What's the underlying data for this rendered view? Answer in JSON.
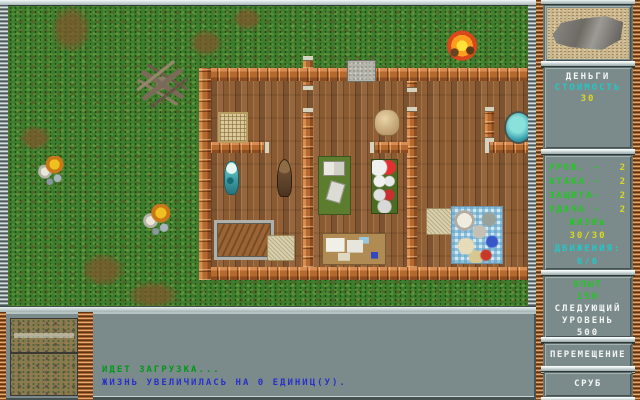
{
  "colors": {
    "panel_gray": "#7b8b8b",
    "label_green": "#20c820",
    "value_yellow": "#d8d820",
    "accent_cyan": "#20c8c8",
    "msg_green": "#009818",
    "msg_blue": "#2830c8",
    "wall_orange": "#bc6f38",
    "grass_green": "#3f7d2e"
  },
  "sidebar": {
    "money": {
      "title": "ДЕНЬГИ",
      "cost_label": "СТОИМОСТЬ",
      "cost_value": "30"
    },
    "stats": {
      "rows": [
        {
          "label": "УРОВ. -",
          "value": "2"
        },
        {
          "label": "АТАКА -",
          "value": "2"
        },
        {
          "label": "ЗАЩИТА-",
          "value": "2"
        },
        {
          "label": "УДАЧА -",
          "value": "2"
        }
      ],
      "life_label": "ЖИЗНЬ",
      "life_value": "30/30",
      "moves_label": "ДВИЖЕНИЯ:",
      "moves_value": "6/6"
    },
    "experience": {
      "label": "ОПЫТ",
      "value": "150",
      "next_line_1": "СЛЕДУЮЩИЙ",
      "next_line_2": "УРОВЕНЬ",
      "next_value": "500"
    },
    "buttons": [
      {
        "label": "ПЕРЕМЕЩЕНИЕ"
      },
      {
        "label": "СРУБ"
      }
    ]
  },
  "messages": {
    "line1": "ИДЕТ ЗАГРУЗКА...",
    "line2": "ЖИЗНЬ УВЕЛИЧИЛАСЬ НА 0 ЕДИНИЦ(У)."
  },
  "map": {
    "objects": [
      {
        "name": "dirt-patch",
        "cls": "dirt",
        "x": 44,
        "y": 0,
        "w": 38,
        "h": 46,
        "it": false
      },
      {
        "name": "dirt-patch",
        "cls": "dirt",
        "x": 182,
        "y": 24,
        "w": 32,
        "h": 26,
        "it": false
      },
      {
        "name": "dirt-patch",
        "cls": "dirt",
        "x": 225,
        "y": 2,
        "w": 28,
        "h": 22,
        "it": false
      },
      {
        "name": "dirt-patch",
        "cls": "dirt",
        "x": 12,
        "y": 120,
        "w": 30,
        "h": 24,
        "it": false
      },
      {
        "name": "dirt-patch",
        "cls": "dirt",
        "x": 74,
        "y": 248,
        "w": 42,
        "h": 32,
        "it": false
      },
      {
        "name": "dirt-patch",
        "cls": "dirt",
        "x": 120,
        "y": 276,
        "w": 50,
        "h": 26,
        "it": false
      },
      {
        "name": "dead-tree",
        "cls": "dead-tree",
        "x": 125,
        "y": 52,
        "w": 58,
        "h": 50,
        "it": true
      },
      {
        "name": "flower-cluster",
        "cls": "flowers",
        "x": 28,
        "y": 150,
        "w": 30,
        "h": 30,
        "it": true
      },
      {
        "name": "flower-cluster",
        "cls": "flowers",
        "x": 133,
        "y": 198,
        "w": 32,
        "h": 32,
        "it": true
      },
      {
        "name": "campfire",
        "cls": "campfire",
        "x": 437,
        "y": 22,
        "w": 34,
        "h": 34,
        "it": true
      },
      {
        "name": "house-floor",
        "cls": "floor",
        "x": 191,
        "y": 62,
        "w": 337,
        "h": 212,
        "it": false
      },
      {
        "name": "house-wall-top",
        "cls": "wall-h",
        "x": 191,
        "y": 62,
        "w": 337,
        "h": 13,
        "it": false
      },
      {
        "name": "house-wall-bottom",
        "cls": "wall-h",
        "x": 191,
        "y": 261,
        "w": 337,
        "h": 13,
        "it": false
      },
      {
        "name": "house-wall-left",
        "cls": "wall-v",
        "x": 191,
        "y": 62,
        "w": 12,
        "h": 212,
        "it": false
      },
      {
        "name": "chimney-stub",
        "cls": "wall-v cap-top",
        "x": 295,
        "y": 50,
        "w": 10,
        "h": 12,
        "it": false
      },
      {
        "name": "inner-wall",
        "cls": "wall-v cap-bottom",
        "x": 295,
        "y": 75,
        "w": 10,
        "h": 9,
        "it": false
      },
      {
        "name": "inner-wall",
        "cls": "wall-v cap-top",
        "x": 295,
        "y": 102,
        "w": 10,
        "h": 159,
        "it": false
      },
      {
        "name": "inner-wall",
        "cls": "wall-v cap-bottom",
        "x": 399,
        "y": 75,
        "w": 10,
        "h": 11,
        "it": false
      },
      {
        "name": "inner-wall",
        "cls": "wall-v cap-top",
        "x": 399,
        "y": 101,
        "w": 10,
        "h": 160,
        "it": false
      },
      {
        "name": "inner-wall",
        "cls": "wall-v cap-top cap-bottom",
        "x": 477,
        "y": 101,
        "w": 9,
        "h": 35,
        "it": false
      },
      {
        "name": "inner-wall",
        "cls": "wall-h cap-right",
        "x": 203,
        "y": 136,
        "w": 58,
        "h": 11,
        "it": false
      },
      {
        "name": "inner-wall",
        "cls": "wall-h cap-left",
        "x": 362,
        "y": 136,
        "w": 38,
        "h": 11,
        "it": false
      },
      {
        "name": "inner-wall",
        "cls": "wall-h cap-left",
        "x": 477,
        "y": 136,
        "w": 43,
        "h": 11,
        "it": false
      },
      {
        "name": "stone-doormat",
        "cls": "slab",
        "x": 339,
        "y": 54,
        "w": 27,
        "h": 20,
        "it": true
      },
      {
        "name": "wicker-crate",
        "cls": "basket",
        "x": 210,
        "y": 106,
        "w": 26,
        "h": 27,
        "it": true
      },
      {
        "name": "hanging-fish",
        "cls": "fish-a",
        "x": 216,
        "y": 155,
        "w": 15,
        "h": 34,
        "it": true
      },
      {
        "name": "hanging-fish",
        "cls": "fish-b",
        "x": 269,
        "y": 153,
        "w": 15,
        "h": 38,
        "it": true
      },
      {
        "name": "wooden-trough",
        "cls": "trough",
        "x": 206,
        "y": 214,
        "w": 54,
        "h": 34,
        "it": true
      },
      {
        "name": "wicker-mat",
        "cls": "mat",
        "x": 259,
        "y": 229,
        "w": 26,
        "h": 24,
        "it": true
      },
      {
        "name": "writing-desk",
        "cls": "green-desk",
        "x": 310,
        "y": 150,
        "w": 31,
        "h": 57,
        "it": true
      },
      {
        "name": "potion-shelf",
        "cls": "potion-shelf",
        "x": 363,
        "y": 153,
        "w": 25,
        "h": 53,
        "it": true
      },
      {
        "name": "map-table",
        "cls": "paper-table",
        "x": 314,
        "y": 227,
        "w": 62,
        "h": 30,
        "it": true
      },
      {
        "name": "grain-sack",
        "cls": "sack",
        "x": 366,
        "y": 103,
        "w": 24,
        "h": 25,
        "it": true
      },
      {
        "name": "water-basin",
        "cls": "basin",
        "x": 496,
        "y": 105,
        "w": 25,
        "h": 29,
        "it": true
      },
      {
        "name": "straw-mat",
        "cls": "mat",
        "x": 418,
        "y": 202,
        "w": 24,
        "h": 25,
        "it": true
      },
      {
        "name": "picnic-blanket",
        "cls": "picnic",
        "x": 443,
        "y": 200,
        "w": 50,
        "h": 56,
        "it": true
      }
    ]
  }
}
